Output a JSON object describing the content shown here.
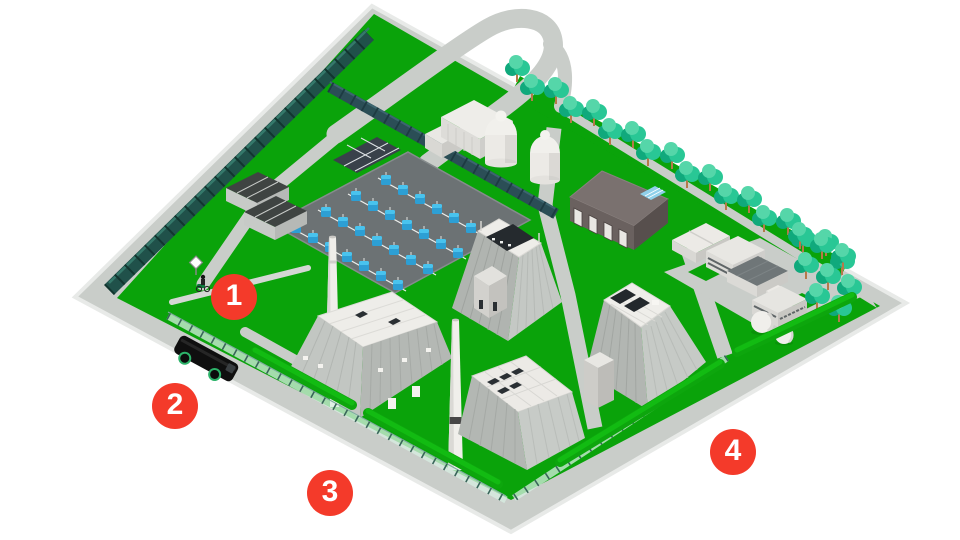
{
  "markers": [
    {
      "id": "marker-1",
      "label": "1"
    },
    {
      "id": "marker-2",
      "label": "2"
    },
    {
      "id": "marker-3",
      "label": "3"
    },
    {
      "id": "marker-4",
      "label": "4"
    }
  ],
  "palette": {
    "background": "#ffffff",
    "grass": "#0aa30a",
    "hedge": "#0da60d",
    "road": "#c9cdc9",
    "curb": "#e8eae8",
    "switchyard_pad": "#6c7274",
    "marker_red": "#f43a2a",
    "marker_label": "#ffffff",
    "tree_canopy": "#29c795",
    "tree_canopy_light": "#55d6a9",
    "tree_canopy_dark": "#10a97c",
    "tree_trunk": "#b5794a",
    "fence_dark_green": "#20514a",
    "fence_wall_teal": "#2b4e56",
    "transformer_blue": "#49c3ee",
    "building_white": "#efeeea",
    "building_light_grey": "#c6cac6",
    "building_mid_grey": "#b2b6b2",
    "warehouse_dark": "#6a615f",
    "skylight_blue": "#8fd0ea",
    "equipment_dark": "#252a2e",
    "truck_black": "#0f0f0f",
    "wheel_green_rim": "#2db36a"
  },
  "features": [
    "perimeter-road",
    "loop-road",
    "switchyard-with-transformers",
    "cooling-domes",
    "turbine-hall-with-chimneys",
    "boiler-houses",
    "dark-warehouse",
    "office-cluster",
    "storage-spheres",
    "tree-line",
    "security-fence",
    "hedges",
    "truck",
    "cyclist-at-gate"
  ]
}
